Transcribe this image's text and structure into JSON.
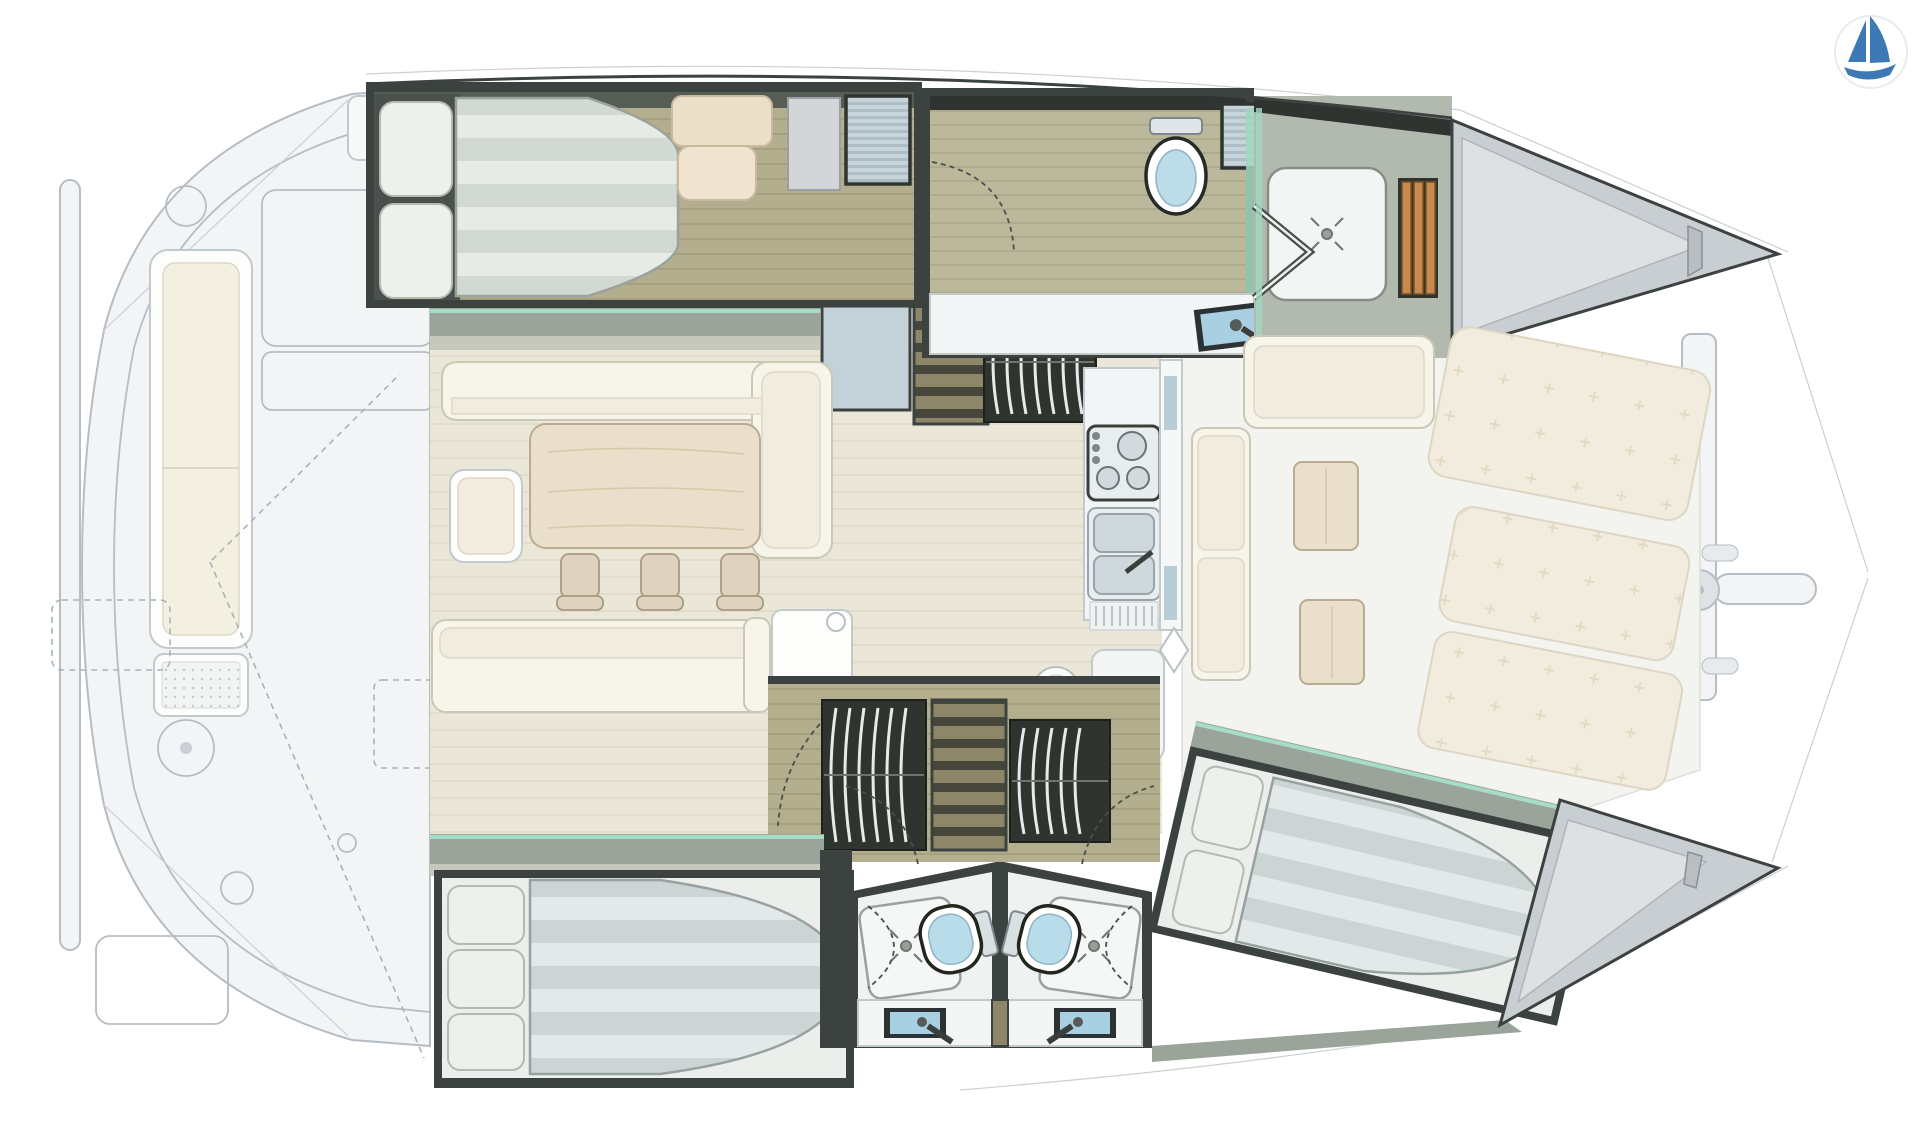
{
  "document": {
    "kind": "catamaran-interior-floor-plan",
    "orientation": "bow-right",
    "visible_text": []
  },
  "logo": {
    "icon": "sailboat-logo-icon",
    "color": "#3d7ab5"
  },
  "colors": {
    "bg": "#ffffff",
    "frameDark": "#3c423f",
    "frameDeep": "#2f3431",
    "sillGreen": "#9aa49a",
    "sillLight": "#c5c8ba",
    "tealAccent": "#a5ddc6",
    "cream": "#f7f4e9",
    "creamInner": "#f1ecdf",
    "creamStroke": "#cbc8b8",
    "woodTable": "#e9dfca",
    "woodStroke": "#b9ac92",
    "chairTan": "#dfd3bf",
    "pillow": "#eef0ec",
    "steel": "#e8edef",
    "steelStroke": "#9aa4a8",
    "glassBlue": "#a9cfe2",
    "teak": "#c98a4e",
    "teakStroke": "#7e5227",
    "bowGray": "#c9ced2",
    "bowInner": "#dde1e4",
    "ghostFill": "#f3f4f5",
    "ghostStroke": "#b6bdc3",
    "ghostCushion": "#f4f0e1",
    "white": "#fdfdfc",
    "tambourDark": "#30342f",
    "tambourArc": "#e8eae8",
    "sunpad": "#f1ecdd",
    "logoBlue": "#3d7ab5"
  },
  "plan": {
    "upper_hull": {
      "rooms": [
        {
          "name": "aft-cabin",
          "furniture": [
            "double-bed",
            "pillow",
            "pillow",
            "seat",
            "wardrobe",
            "locker"
          ]
        },
        {
          "name": "bathroom",
          "furniture": [
            "toilet",
            "cabinet",
            "washbasin",
            "door-swing"
          ]
        },
        {
          "name": "shower-room",
          "furniture": [
            "shower-tray",
            "drain",
            "folding-door",
            "teak-grating"
          ]
        },
        {
          "name": "bow-locker",
          "furniture": []
        }
      ],
      "companionway": {
        "parts": [
          "storage-box",
          "steps",
          "tambour-door",
          "sliding-door-track"
        ]
      }
    },
    "salon": {
      "furniture": [
        "l-sofa",
        "chaise-seat",
        "dining-table",
        "chair",
        "chair",
        "chair",
        "aft-sofa",
        "cooler-box",
        "stove",
        "double-sink",
        "drainboard",
        "nav-console",
        "stool"
      ]
    },
    "forward-cockpit": {
      "furniture": [
        "corner-bench",
        "side-bench",
        "low-table",
        "low-table",
        "sunpad",
        "sunpad",
        "sunpad",
        "forward-beam",
        "bowsprit",
        "trampoline-lines"
      ]
    },
    "lower_hull": {
      "rooms": [
        {
          "name": "aft-cabin",
          "furniture": [
            "double-bed",
            "pillow",
            "pillow",
            "pillow"
          ]
        },
        {
          "name": "bathroom-left",
          "furniture": [
            "shower-tray",
            "toilet",
            "washbasin"
          ]
        },
        {
          "name": "bathroom-right",
          "furniture": [
            "shower-tray",
            "toilet",
            "washbasin"
          ]
        },
        {
          "name": "forward-cabin",
          "furniture": [
            "double-bed",
            "pillow",
            "pillow"
          ]
        },
        {
          "name": "bow-locker",
          "furniture": []
        }
      ],
      "companionway": {
        "parts": [
          "tambour-door",
          "steps",
          "tambour-door",
          "door-swing",
          "door-swing"
        ]
      }
    },
    "aft-cockpit": {
      "furniture": [
        "bench",
        "grill-module",
        "deck-hatch",
        "deck-hatch",
        "deck-fitting",
        "liferaft-outline"
      ]
    }
  }
}
